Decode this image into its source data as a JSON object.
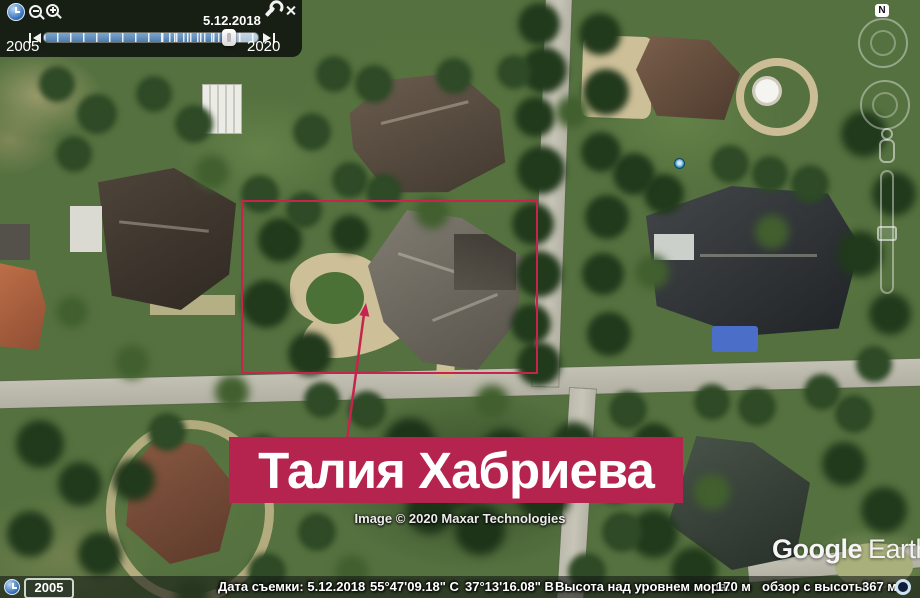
{
  "app": "Google Earth",
  "time_slider": {
    "current_date": "5.12.2018",
    "range_start": "2005",
    "range_end": "2020"
  },
  "compass": {
    "north": "N"
  },
  "annotation": {
    "label": "Талия Хабриева"
  },
  "attribution": "Image © 2020 Maxar Technologies",
  "logo": {
    "part1": "Google",
    "part2": "Earth"
  },
  "status_bar": {
    "history_year": "2005",
    "capture_date": "Дата съемки: 5.12.2018",
    "latitude": "55°47'09.18\" С",
    "longitude": "37°13'16.08\" В",
    "altitude_label": "Высота над уровнем моря:",
    "altitude_value": "170 м",
    "eye_altitude_label": "обзор с высоты",
    "eye_altitude_value": "367 м"
  },
  "colors": {
    "annotation_fill": "#b5244e",
    "annotation_outline": "#c6234d"
  }
}
